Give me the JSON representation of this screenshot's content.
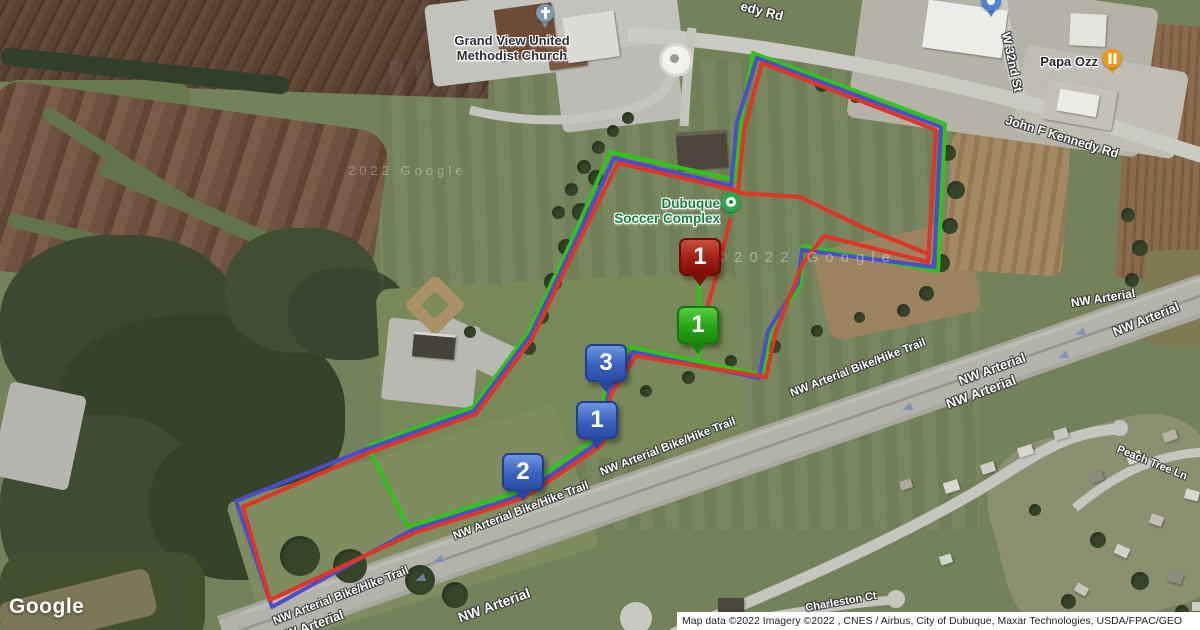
{
  "routes": [
    {
      "name": "route-green",
      "color": "#2fc418",
      "width": 4,
      "points": [
        [
          753,
          53
        ],
        [
          945,
          124
        ],
        [
          938,
          271
        ],
        [
          803,
          246
        ],
        [
          801,
          284
        ],
        [
          771,
          330
        ],
        [
          763,
          375
        ],
        [
          630,
          347
        ],
        [
          606,
          387
        ],
        [
          597,
          437
        ],
        [
          520,
          491
        ],
        [
          408,
          527
        ],
        [
          385,
          481
        ],
        [
          368,
          446
        ],
        [
          473,
          407
        ],
        [
          528,
          333
        ],
        [
          572,
          240
        ],
        [
          610,
          152
        ],
        [
          735,
          180
        ],
        [
          741,
          120
        ],
        [
          753,
          53
        ]
      ]
    },
    {
      "name": "route-blue",
      "color": "#4a4ecb",
      "width": 4,
      "points": [
        [
          757,
          58
        ],
        [
          941,
          127
        ],
        [
          934,
          267
        ],
        [
          802,
          250
        ],
        [
          798,
          283
        ],
        [
          768,
          331
        ],
        [
          759,
          378
        ],
        [
          633,
          352
        ],
        [
          609,
          391
        ],
        [
          600,
          441
        ],
        [
          523,
          495
        ],
        [
          412,
          530
        ],
        [
          272,
          607
        ],
        [
          236,
          501
        ],
        [
          367,
          449
        ],
        [
          474,
          411
        ],
        [
          530,
          336
        ],
        [
          574,
          244
        ],
        [
          614,
          158
        ],
        [
          731,
          186
        ],
        [
          737,
          122
        ],
        [
          757,
          58
        ]
      ]
    },
    {
      "name": "route-red",
      "color": "#e03524",
      "width": 4,
      "points": [
        [
          762,
          63
        ],
        [
          936,
          130
        ],
        [
          928,
          262
        ],
        [
          824,
          236
        ],
        [
          803,
          263
        ],
        [
          776,
          331
        ],
        [
          766,
          377
        ],
        [
          636,
          356
        ],
        [
          611,
          394
        ],
        [
          602,
          445
        ],
        [
          524,
          498
        ],
        [
          414,
          533
        ],
        [
          270,
          600
        ],
        [
          243,
          507
        ],
        [
          368,
          453
        ],
        [
          476,
          414
        ],
        [
          532,
          339
        ],
        [
          576,
          247
        ],
        [
          618,
          163
        ],
        [
          738,
          191
        ],
        [
          744,
          130
        ],
        [
          762,
          63
        ]
      ]
    },
    {
      "name": "route-red-cut",
      "color": "#e03524",
      "width": 4,
      "points": [
        [
          738,
          193
        ],
        [
          800,
          197
        ],
        [
          862,
          227
        ],
        [
          926,
          253
        ]
      ]
    },
    {
      "name": "route-red-finish-spur",
      "color": "#e03524",
      "width": 4,
      "points": [
        [
          736,
          195
        ],
        [
          718,
          271
        ],
        [
          704,
          318
        ]
      ]
    },
    {
      "name": "route-green-start-spur",
      "color": "#2fc418",
      "width": 4,
      "points": [
        [
          699,
          283
        ],
        [
          699,
          357
        ]
      ]
    }
  ],
  "markers": {
    "red_1": {
      "label": "1"
    },
    "green_1": {
      "label": "1"
    },
    "blue_3": {
      "label": "3"
    },
    "blue_1": {
      "label": "1"
    },
    "blue_2": {
      "label": "2"
    }
  },
  "pois": {
    "church": {
      "line1": "Grand View United",
      "line2": "Methodist Church"
    },
    "soccer_complex": {
      "line1": "Dubuque",
      "line2": "Soccer Complex"
    },
    "papa_ozz": {
      "label": "Papa Ozz"
    }
  },
  "road_labels": {
    "kennedy_top": "edy Rd",
    "w_32nd_st": "W 32nd St",
    "john_f_kennedy_rd": "John F Kennedy Rd",
    "trail_1": "NW Arterial Bike/Hike Trail",
    "trail_2": "NW Arterial Bike/Hike Trail",
    "trail_3": "NW Arterial Bike/Hike Trail",
    "trail_4": "NW Arterial Bike/Hike Trail",
    "nw_arterial_1": "NW Arterial",
    "nw_arterial_2": "NW Arterial",
    "nw_arterial_3": "NW Arterial",
    "nw_arterial_4": "NW Arterial",
    "nw_arterial_5": "NW Arterial",
    "nw_arterial_6": "NW Arterial",
    "peach_tree_ln": "Peach Tree Ln",
    "charleston_ct": "Charleston Ct"
  },
  "watermarks": {
    "center": "©2022 Google",
    "left": "2022 Google"
  },
  "footer": {
    "logo": "Google",
    "attribution": "Map data ©2022 Imagery ©2022 , CNES / Airbus, City of Dubuque, Maxar Technologies, USDA/FPAC/GEO"
  },
  "colors": {
    "route_green": "#2fc418",
    "route_blue": "#4a4ecb",
    "route_red": "#e03524",
    "marker_blue": "#3a62bc",
    "marker_red": "#a01d13",
    "marker_green": "#27a317",
    "poi_green": "#14823c",
    "pin_orange": "#f09813",
    "pin_gray_blue": "#7e99ad",
    "highway_gray": "#b3b3ab",
    "grass": "#73825a"
  }
}
